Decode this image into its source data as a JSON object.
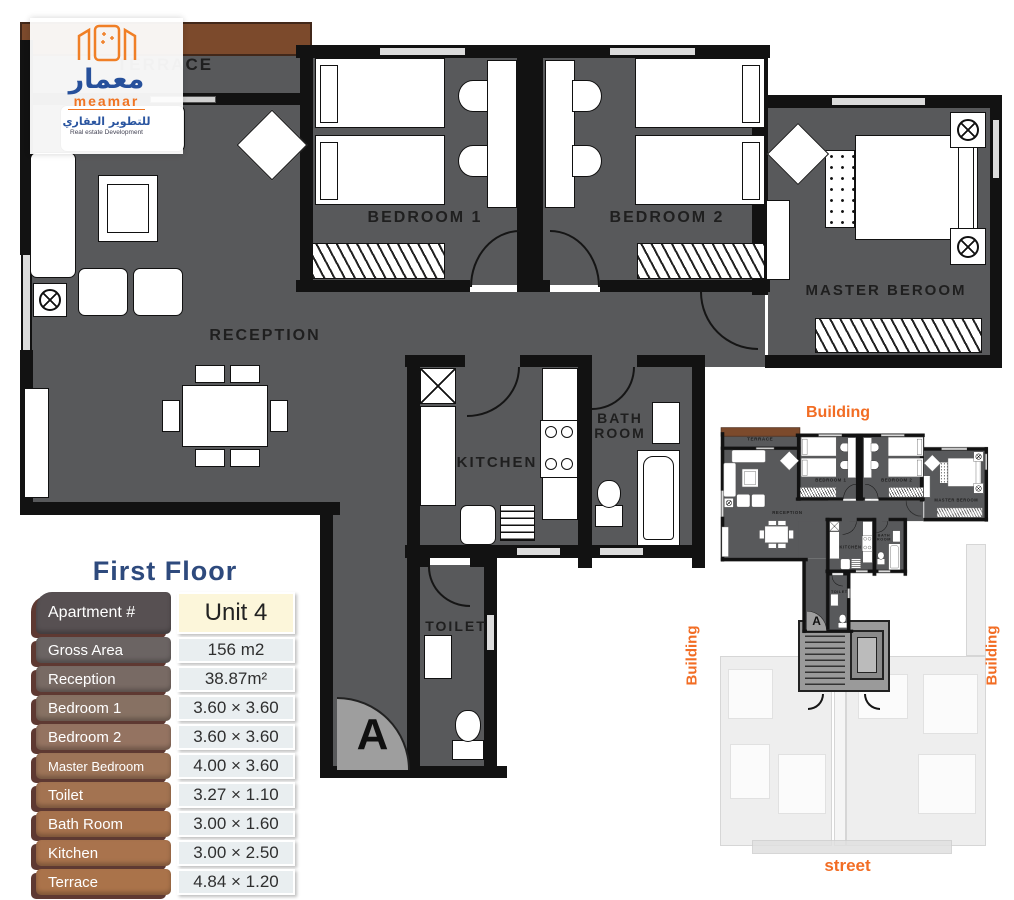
{
  "logo": {
    "arabic_name": "معمار",
    "latin_name": "meamar",
    "arabic_tagline": "للتطوير العقاري",
    "english_tagline": "Real estate Development"
  },
  "floor_plan": {
    "rooms": {
      "terrace": "TERRACE",
      "reception": "RECEPTION",
      "bedroom1": "BEDROOM 1",
      "bedroom2": "BEDROOM 2",
      "master": "MASTER BEROOM",
      "kitchen": "KITCHEN",
      "bath_line1": "BATH",
      "bath_line2": "ROOM",
      "toilet": "TOILET",
      "entrance_marker": "A"
    }
  },
  "details_table": {
    "title": "First Floor",
    "header": {
      "label": "Apartment #",
      "value": "Unit 4"
    },
    "rows": [
      {
        "label": "Gross Area",
        "value": "156 m2"
      },
      {
        "label": "Reception",
        "value": "38.87m²"
      },
      {
        "label": "Bedroom 1",
        "value": "3.60 × 3.60"
      },
      {
        "label": "Bedroom 2",
        "value": "3.60 × 3.60"
      },
      {
        "label": "Master Bedroom",
        "value": "4.00 × 3.60"
      },
      {
        "label": "Toilet",
        "value": "3.27 × 1.10"
      },
      {
        "label": "Bath Room",
        "value": "3.00 × 1.60"
      },
      {
        "label": "Kitchen",
        "value": "3.00 × 2.50"
      },
      {
        "label": "Terrace",
        "value": "4.84 × 1.20"
      }
    ]
  },
  "site_plan": {
    "labels": {
      "top": "Building",
      "left": "Building",
      "right": "Building",
      "bottom": "street"
    }
  },
  "colors": {
    "accent_orange": "#f26d24",
    "title_navy": "#2e4a7d",
    "floor_gray": "#58595b",
    "wall_black": "#121212",
    "terrace_brown": "#7c4a2c",
    "logo_blue": "#27509b",
    "logo_orange": "#f07422",
    "value_cell_bg": "#e9eef0",
    "unit_cell_bg": "#fcf6da"
  }
}
